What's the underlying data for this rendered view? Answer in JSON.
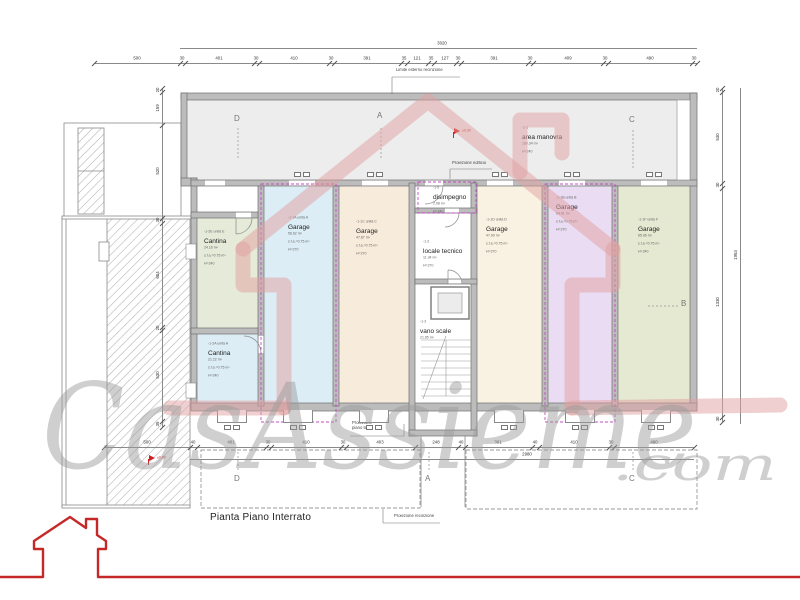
{
  "title": "Pianta Piano Interrato",
  "watermark": {
    "text": "CasAssieme",
    "suffix": ".com"
  },
  "colors": {
    "wall": "#bcbcbc",
    "wall_edge": "#6f6f6f",
    "unit_boundary": "#c44ac4",
    "logo_red": "#c62828",
    "watermark_pink": "#dfa0a0",
    "watermark_gray": "#9a9a9a"
  },
  "rooms": [
    {
      "key": "area-manovra",
      "x": 187,
      "y": 99,
      "w": 503,
      "h": 81,
      "color": "#ededed",
      "label": {
        "x": 522,
        "y": 126,
        "lines": [
          "-1-1",
          "area manovra",
          "180.34 m²",
          "H=240"
        ]
      }
    },
    {
      "key": "cantina-e",
      "x": 197,
      "y": 218,
      "w": 61,
      "h": 110,
      "color": "#e6ead9",
      "label": {
        "x": 204,
        "y": 230,
        "lines": [
          "-1-2E unità E",
          "Cantina",
          "24.16 m²",
          "s.f.a.=0.75 m²",
          "H=240"
        ]
      }
    },
    {
      "key": "cantina-a",
      "x": 197,
      "y": 334,
      "w": 61,
      "h": 69,
      "color": "#dcedf6",
      "label": {
        "x": 208,
        "y": 342,
        "lines": [
          "-1-2A unità A",
          "Cantina",
          "21.22 m²",
          "s.f.a.=0.75 m²",
          "H=240"
        ]
      }
    },
    {
      "key": "garage-a",
      "x": 264,
      "y": 186,
      "w": 69,
      "h": 217,
      "color": "#dcedf6",
      "label": {
        "x": 288,
        "y": 216,
        "lines": [
          "-1-1A unità A",
          "Garage",
          "56.62 m²",
          "s.f.a.=0.75 m²",
          "H=270"
        ]
      }
    },
    {
      "key": "garage-c",
      "x": 339,
      "y": 186,
      "w": 70,
      "h": 217,
      "color": "#f7ecdc",
      "label": {
        "x": 356,
        "y": 220,
        "lines": [
          "-1-1C unità C",
          "Garage",
          "47.87 m²",
          "s.f.a.=0.75 m²",
          "H=270"
        ]
      }
    },
    {
      "key": "garage-d",
      "x": 477,
      "y": 186,
      "w": 65,
      "h": 217,
      "color": "#f9f2e2",
      "label": {
        "x": 486,
        "y": 218,
        "lines": [
          "-1-1D unità D",
          "Garage",
          "47.90 m²",
          "s.f.a.=0.75 m²",
          "H=270"
        ]
      }
    },
    {
      "key": "garage-b",
      "x": 548,
      "y": 186,
      "w": 64,
      "h": 217,
      "color": "#eadcf2",
      "label": {
        "x": 556,
        "y": 196,
        "lines": [
          "-1-1B unità B",
          "Garage",
          "54.81 m²",
          "s.f.a.=0.75 m²",
          "H=270"
        ]
      }
    },
    {
      "key": "garage-f",
      "x": 618,
      "y": 186,
      "w": 72,
      "h": 217,
      "color": "#e5e9d2",
      "label": {
        "x": 638,
        "y": 218,
        "lines": [
          "-1-1F unità F",
          "Garage",
          "65.06 m²",
          "s.f.a.=0.75 m²",
          "H=240"
        ]
      }
    },
    {
      "key": "disimpegno",
      "x": 415,
      "y": 186,
      "w": 56,
      "h": 22,
      "color": "#ffffff",
      "label": {
        "x": 433,
        "y": 186,
        "lines": [
          "-1-5",
          "disimpegno",
          "2.08 m²",
          "H=240"
        ]
      }
    },
    {
      "key": "locale-tecnico",
      "x": 415,
      "y": 213,
      "w": 56,
      "h": 66,
      "color": "#ffffff",
      "label": {
        "x": 423,
        "y": 240,
        "lines": [
          "-1-2",
          "locale tecnico",
          "11.34 m²",
          "H=270"
        ]
      }
    },
    {
      "key": "vano-scale",
      "x": 415,
      "y": 284,
      "w": 56,
      "h": 146,
      "color": "#ffffff",
      "label": {
        "x": 420,
        "y": 320,
        "lines": [
          "-1-3",
          "vano scale",
          "21.85 m²"
        ]
      }
    }
  ],
  "dims": {
    "top_total": {
      "y": 48,
      "x1": 180,
      "x2": 697,
      "label": "3020",
      "lx": 442
    },
    "top": {
      "y": 63,
      "x1": 94,
      "x2": 697,
      "ticks": [
        94,
        180,
        185,
        254,
        259,
        329,
        334,
        401,
        407,
        428,
        434,
        456,
        461,
        528,
        533,
        603,
        608,
        692,
        697
      ],
      "labels": [
        [
          "500",
          137
        ],
        [
          "30",
          182
        ],
        [
          "401",
          219
        ],
        [
          "30",
          256
        ],
        [
          "410",
          294
        ],
        [
          "30",
          331
        ],
        [
          "391",
          367
        ],
        [
          "35",
          404
        ],
        [
          "121",
          417
        ],
        [
          "35",
          431
        ],
        [
          "127",
          445
        ],
        [
          "30",
          458
        ],
        [
          "391",
          494
        ],
        [
          "30",
          530
        ],
        [
          "409",
          568
        ],
        [
          "30",
          605
        ],
        [
          "490",
          650
        ],
        [
          "30",
          694
        ]
      ]
    },
    "bottom": {
      "y": 447,
      "x1": 104,
      "x2": 694,
      "ticks": [
        104,
        190,
        197,
        266,
        271,
        341,
        346,
        415,
        458,
        465,
        532,
        539,
        609,
        614,
        694
      ],
      "labels": [
        [
          "500",
          147
        ],
        [
          "40",
          193
        ],
        [
          "401",
          231
        ],
        [
          "30",
          268
        ],
        [
          "410",
          306
        ],
        [
          "30",
          343
        ],
        [
          "403",
          380
        ],
        [
          "248",
          436
        ],
        [
          "40",
          461
        ],
        [
          "391",
          498
        ],
        [
          "40",
          535
        ],
        [
          "410",
          574
        ],
        [
          "30",
          611
        ],
        [
          "490",
          654
        ]
      ]
    },
    "bottom_total": {
      "y": 459,
      "x1": 190,
      "x2": 694,
      "label": "2980",
      "lx": 527
    },
    "left": {
      "x": 162,
      "y1": 88,
      "y2": 427,
      "ticks": [
        88,
        92,
        125,
        218,
        223,
        327,
        330,
        421,
        427
      ],
      "labels": [
        [
          "20",
          90
        ],
        [
          "159",
          108
        ],
        [
          "520",
          171
        ],
        [
          "30",
          220
        ],
        [
          "604",
          275
        ],
        [
          "20",
          328
        ],
        [
          "530",
          375
        ],
        [
          "35",
          424
        ]
      ]
    },
    "right_inner": {
      "x": 722,
      "y1": 88,
      "y2": 422,
      "ticks": [
        88,
        92,
        183,
        188,
        417,
        422
      ],
      "labels": [
        [
          "20",
          90
        ],
        [
          "530",
          137
        ],
        [
          "30",
          185
        ],
        [
          "1330",
          302
        ],
        [
          "30",
          419
        ]
      ]
    },
    "right_outer": {
      "x": 740,
      "y1": 88,
      "y2": 424,
      "label": "1953",
      "ly": 255
    }
  },
  "annotations": [
    {
      "key": "limite-esterno-recinzione",
      "x": 396,
      "y": 68,
      "text": "Limite esterno recinzione"
    },
    {
      "key": "proiezione-edificio",
      "x": 452,
      "y": 161,
      "text": "Proiezione edificio"
    },
    {
      "key": "proiezione-piano-terra",
      "x": 352,
      "y": 421,
      "text": "Proiezione\npiano terra"
    },
    {
      "key": "proiezione-recinzione",
      "x": 394,
      "y": 514,
      "text": "Proiezione recinzione"
    }
  ],
  "sections": [
    {
      "l": "D",
      "x": 234,
      "y": 114
    },
    {
      "l": "A",
      "x": 377,
      "y": 111
    },
    {
      "l": "C",
      "x": 629,
      "y": 115
    },
    {
      "l": "B",
      "x": 681,
      "y": 299
    },
    {
      "l": "D",
      "x": 234,
      "y": 474
    },
    {
      "l": "A",
      "x": 425,
      "y": 474
    },
    {
      "l": "C",
      "x": 629,
      "y": 474
    }
  ],
  "level_pins": [
    {
      "x": 453,
      "y": 132,
      "text": "±0.00"
    },
    {
      "x": 148,
      "y": 459,
      "text": "±0.00"
    }
  ],
  "door_markers": {
    "top_y": 172,
    "top": [
      302,
      375,
      500,
      572,
      654
    ],
    "bottom_y": 425,
    "bottom": [
      232,
      298,
      374,
      509,
      580,
      656
    ]
  },
  "notches": {
    "y": 410,
    "centers": [
      232,
      298,
      374,
      509,
      580,
      656
    ]
  }
}
